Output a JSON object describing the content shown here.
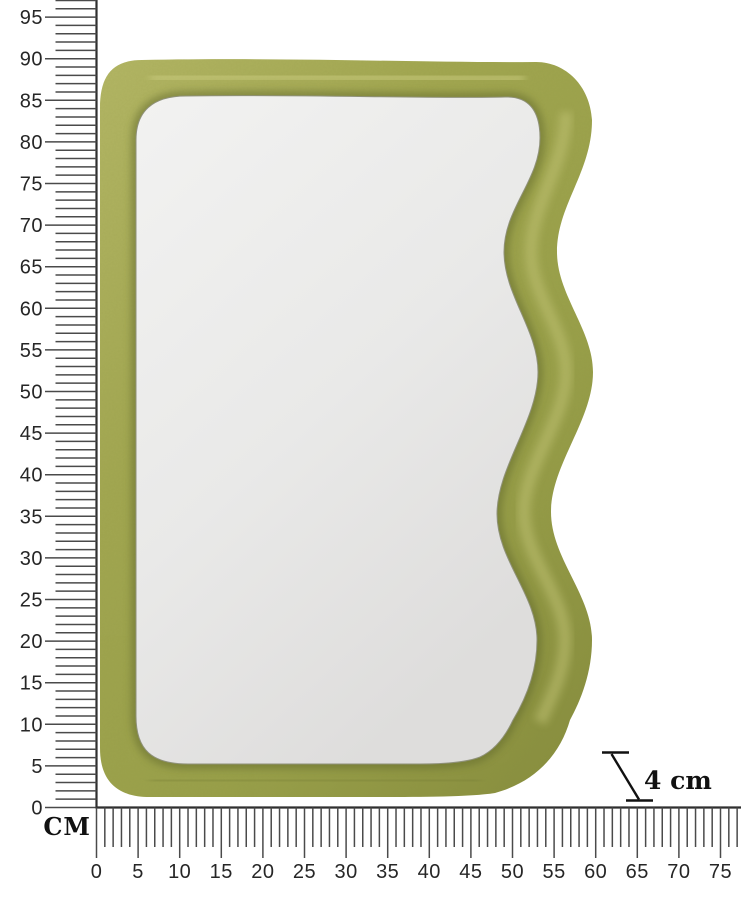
{
  "page": {
    "background": "#ffffff",
    "description": "Product dimension diagram of a wavy-edge velvet mirror with centimeter rulers"
  },
  "product": {
    "name": "wavy-frame-mirror",
    "frame_color_highlight": "#bcbe70",
    "frame_color_base": "#9da34c",
    "frame_color_mid": "#8a9040",
    "frame_color_shadow": "#646b2b",
    "mirror_color_light": "#f2f2f1",
    "mirror_color_dark": "#dedddc"
  },
  "rulers": {
    "unit_label": "CM",
    "px_per_cm": 8.32,
    "origin": {
      "x": 96.5,
      "y": 807.5
    },
    "tick_color": "#4a4a4a",
    "baseline_color": "#2e2e2e",
    "vertical": {
      "max_cm": 97,
      "label_step": 5,
      "labels": [
        "0",
        "5",
        "10",
        "15",
        "20",
        "25",
        "30",
        "35",
        "40",
        "45",
        "50",
        "55",
        "60",
        "65",
        "70",
        "75",
        "80",
        "85",
        "90",
        "95"
      ]
    },
    "horizontal": {
      "max_cm": 77,
      "label_step": 5,
      "labels": [
        "0",
        "5",
        "10",
        "15",
        "20",
        "25",
        "30",
        "35",
        "40",
        "45",
        "50",
        "55",
        "60",
        "65",
        "70",
        "75"
      ]
    }
  },
  "annotation": {
    "thickness_label": "4 cm"
  }
}
